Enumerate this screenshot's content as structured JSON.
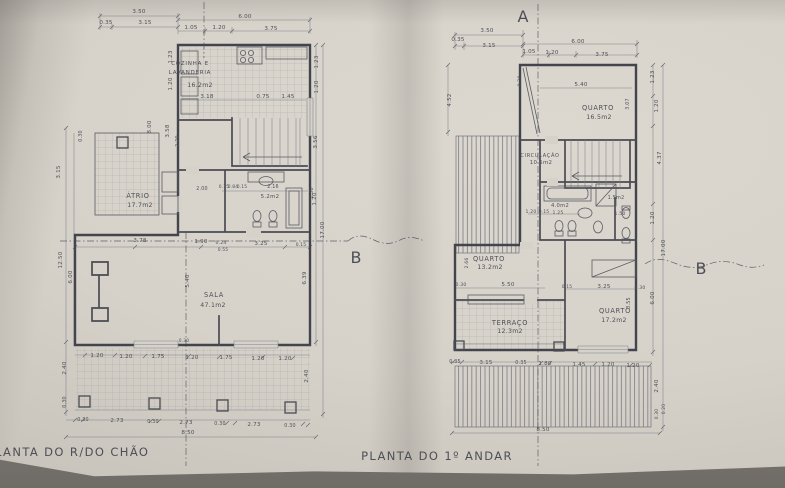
{
  "photo": {
    "paper_color": "#d6d2ca",
    "backdrop_color": "#8a8680",
    "ink_color": "#4e4f56"
  },
  "drawing": {
    "left_plan": {
      "title": "PLANTA DO R/DO CHÃO",
      "section_marker_b": "B",
      "rooms": [
        {
          "name": "COZINHA E LAVANDERIA",
          "area": "16.2m2"
        },
        {
          "name": "ÁTRIO",
          "area": "17.7m2"
        },
        {
          "name": "",
          "area": "5.2m2"
        },
        {
          "name": "SALA",
          "area": "47.1m2"
        }
      ],
      "labels": [
        {
          "t": "3.50",
          "x": 139,
          "y": 13
        },
        {
          "t": "0.35",
          "x": 106,
          "y": 24
        },
        {
          "t": "3.15",
          "x": 145,
          "y": 24
        },
        {
          "t": "6.00",
          "x": 245,
          "y": 18
        },
        {
          "t": "1.05",
          "x": 191,
          "y": 29
        },
        {
          "t": "1.20",
          "x": 219,
          "y": 29
        },
        {
          "t": "3.75",
          "x": 271,
          "y": 30
        },
        {
          "t": "COZINHA E",
          "x": 190,
          "y": 65,
          "k": "room",
          "fs": 5.6,
          "a": "start"
        },
        {
          "t": "LAVANDERIA",
          "x": 190,
          "y": 74,
          "k": "room",
          "fs": 5.6,
          "a": "start"
        },
        {
          "t": "16.2m2",
          "x": 200,
          "y": 87,
          "k": "area",
          "a": "start"
        },
        {
          "t": "3.18",
          "x": 207,
          "y": 98
        },
        {
          "t": "0.75",
          "x": 263,
          "y": 98
        },
        {
          "t": "1.45",
          "x": 288,
          "y": 98
        },
        {
          "t": "1.23",
          "x": 172,
          "y": 57,
          "r": -90
        },
        {
          "t": "1.20",
          "x": 172,
          "y": 84,
          "r": -90
        },
        {
          "t": "8.00",
          "x": 151,
          "y": 127,
          "r": -90
        },
        {
          "t": "3.58",
          "x": 169,
          "y": 131,
          "r": -90
        },
        {
          "t": "2.20",
          "x": 179,
          "y": 141,
          "r": -90,
          "fs": 4.8
        },
        {
          "t": "0.30",
          "x": 82,
          "y": 136,
          "r": -90,
          "fs": 4.8
        },
        {
          "t": "3.15",
          "x": 60,
          "y": 172,
          "r": -90
        },
        {
          "t": "12.50",
          "x": 62,
          "y": 260,
          "r": -90
        },
        {
          "t": "6.00",
          "x": 72,
          "y": 277,
          "r": -90
        },
        {
          "t": "2.40",
          "x": 66,
          "y": 368,
          "r": -90
        },
        {
          "t": "0.30",
          "x": 66,
          "y": 402,
          "r": -90,
          "fs": 4.8
        },
        {
          "t": "2.00",
          "x": 202,
          "y": 190,
          "fs": 4.8
        },
        {
          "t": "ÁTRIO",
          "x": 138,
          "y": 198,
          "k": "room"
        },
        {
          "t": "17.7m2",
          "x": 140,
          "y": 207,
          "k": "area"
        },
        {
          "t": "0.15",
          "x": 224,
          "y": 188,
          "fs": 4.4
        },
        {
          "t": "0.84",
          "x": 233,
          "y": 188,
          "fs": 4.4
        },
        {
          "t": "0.15",
          "x": 242,
          "y": 188,
          "fs": 4.4
        },
        {
          "t": "2.16",
          "x": 273,
          "y": 188,
          "fs": 4.8
        },
        {
          "t": "5.2m2",
          "x": 270,
          "y": 198,
          "k": "area",
          "fs": 5.4
        },
        {
          "t": "1.30",
          "x": 313,
          "y": 193,
          "r": -90,
          "fs": 4.8
        },
        {
          "t": "1.23",
          "x": 318,
          "y": 62,
          "r": -90
        },
        {
          "t": "1.20",
          "x": 318,
          "y": 87,
          "r": -90
        },
        {
          "t": "3.56",
          "x": 317,
          "y": 142,
          "r": -90
        },
        {
          "t": "1.20",
          "x": 316,
          "y": 199,
          "r": -90
        },
        {
          "t": "17.00",
          "x": 324,
          "y": 230,
          "r": -90
        },
        {
          "t": "6.39",
          "x": 306,
          "y": 278,
          "r": -90
        },
        {
          "t": "2.40",
          "x": 308,
          "y": 376,
          "r": -90
        },
        {
          "t": "3.78",
          "x": 140,
          "y": 242
        },
        {
          "t": "1.90",
          "x": 201,
          "y": 243
        },
        {
          "t": "0.24",
          "x": 221,
          "y": 244,
          "fs": 4.6
        },
        {
          "t": "0.55",
          "x": 223,
          "y": 251,
          "fs": 4.4
        },
        {
          "t": "3.25",
          "x": 261,
          "y": 245
        },
        {
          "t": "0.15",
          "x": 301,
          "y": 246,
          "fs": 4.4
        },
        {
          "t": "SALA",
          "x": 214,
          "y": 297,
          "k": "room"
        },
        {
          "t": "47.1m2",
          "x": 213,
          "y": 307,
          "k": "area"
        },
        {
          "t": "5.40",
          "x": 189,
          "y": 281,
          "r": -90
        },
        {
          "t": "0.30",
          "x": 184,
          "y": 342,
          "fs": 4.4
        },
        {
          "t": "1.20",
          "x": 97,
          "y": 357
        },
        {
          "t": "1.20",
          "x": 126,
          "y": 358
        },
        {
          "t": "1.75",
          "x": 158,
          "y": 358
        },
        {
          "t": "1.20",
          "x": 192,
          "y": 359
        },
        {
          "t": "1.75",
          "x": 226,
          "y": 359
        },
        {
          "t": "1.20",
          "x": 258,
          "y": 360
        },
        {
          "t": "1.20",
          "x": 285,
          "y": 360
        },
        {
          "t": "0.30",
          "x": 83,
          "y": 421,
          "fs": 4.8
        },
        {
          "t": "2.73",
          "x": 117,
          "y": 422
        },
        {
          "t": "0.30",
          "x": 153,
          "y": 423,
          "fs": 4.8
        },
        {
          "t": "2.73",
          "x": 186,
          "y": 424
        },
        {
          "t": "0.30",
          "x": 220,
          "y": 425,
          "fs": 4.8
        },
        {
          "t": "2.73",
          "x": 254,
          "y": 426
        },
        {
          "t": "0.30",
          "x": 290,
          "y": 427,
          "fs": 4.8
        },
        {
          "t": "8.50",
          "x": 188,
          "y": 434
        }
      ]
    },
    "right_plan": {
      "title": "PLANTA DO 1º ANDAR",
      "section_marker_a": "A",
      "section_marker_b": "B",
      "rooms": [
        {
          "name": "QUARTO",
          "area": "16.5m2"
        },
        {
          "name": "CIRCULAÇÃO",
          "area": "10.5m2"
        },
        {
          "name": "",
          "area": "4.0m2"
        },
        {
          "name": "",
          "area": "1.5m2"
        },
        {
          "name": "QUARTO",
          "area": "13.2m2"
        },
        {
          "name": "TERRAÇO",
          "area": "12.3m2"
        },
        {
          "name": "QUARTO",
          "area": "17.2m2"
        }
      ],
      "labels": [
        {
          "t": "3.50",
          "x": 487,
          "y": 32
        },
        {
          "t": "0.35",
          "x": 458,
          "y": 41
        },
        {
          "t": "3.15",
          "x": 489,
          "y": 47
        },
        {
          "t": "6.00",
          "x": 578,
          "y": 43
        },
        {
          "t": "1.05",
          "x": 529,
          "y": 53
        },
        {
          "t": "1.20",
          "x": 552,
          "y": 54
        },
        {
          "t": "3.75",
          "x": 602,
          "y": 56
        },
        {
          "t": "QUARTO",
          "x": 598,
          "y": 110,
          "k": "room"
        },
        {
          "t": "16.5m2",
          "x": 599,
          "y": 119,
          "k": "area"
        },
        {
          "t": "5.40",
          "x": 581,
          "y": 86
        },
        {
          "t": "0.30",
          "x": 521,
          "y": 81,
          "r": -90,
          "fs": 4.6
        },
        {
          "t": "4.52",
          "x": 451,
          "y": 100,
          "r": -90
        },
        {
          "t": "3.07",
          "x": 629,
          "y": 104,
          "r": -90,
          "fs": 4.8
        },
        {
          "t": "1.23",
          "x": 654,
          "y": 77,
          "r": -90
        },
        {
          "t": "1.20",
          "x": 658,
          "y": 106,
          "r": -90
        },
        {
          "t": "CIRCULAÇÃO",
          "x": 540,
          "y": 157,
          "k": "room",
          "fs": 5
        },
        {
          "t": "10.5m2",
          "x": 541,
          "y": 164,
          "k": "area",
          "fs": 5.4
        },
        {
          "t": "4.37",
          "x": 661,
          "y": 158,
          "r": -90
        },
        {
          "t": "4.0m2",
          "x": 560,
          "y": 207,
          "k": "area",
          "fs": 5.2
        },
        {
          "t": "1.20",
          "x": 531,
          "y": 213,
          "fs": 4.6
        },
        {
          "t": "0.15",
          "x": 544,
          "y": 213,
          "fs": 4.4
        },
        {
          "t": "1.25",
          "x": 558,
          "y": 214,
          "fs": 4.6
        },
        {
          "t": "1.5m2",
          "x": 616,
          "y": 199,
          "k": "area",
          "fs": 4.8
        },
        {
          "t": "1.50",
          "x": 620,
          "y": 215,
          "fs": 4.6
        },
        {
          "t": "1.20",
          "x": 654,
          "y": 218,
          "r": -90
        },
        {
          "t": "QUARTO",
          "x": 489,
          "y": 261,
          "k": "room"
        },
        {
          "t": "13.2m2",
          "x": 490,
          "y": 269,
          "k": "area"
        },
        {
          "t": "2.66",
          "x": 468,
          "y": 263,
          "r": -90,
          "fs": 4.6
        },
        {
          "t": "0.30",
          "x": 461,
          "y": 286,
          "fs": 4.6
        },
        {
          "t": "5.50",
          "x": 508,
          "y": 286
        },
        {
          "t": "17.00",
          "x": 665,
          "y": 248,
          "r": -90
        },
        {
          "t": "TERRAÇO",
          "x": 510,
          "y": 325,
          "k": "room"
        },
        {
          "t": "12.3m2",
          "x": 510,
          "y": 333,
          "k": "area"
        },
        {
          "t": "0.15",
          "x": 567,
          "y": 288,
          "fs": 4.4
        },
        {
          "t": "3.25",
          "x": 604,
          "y": 288
        },
        {
          "t": "0.30",
          "x": 640,
          "y": 289,
          "fs": 4.6
        },
        {
          "t": "QUARTO",
          "x": 615,
          "y": 313,
          "k": "room"
        },
        {
          "t": "17.2m2",
          "x": 614,
          "y": 322,
          "k": "area"
        },
        {
          "t": "3.55",
          "x": 630,
          "y": 303,
          "r": -90,
          "fs": 4.8
        },
        {
          "t": "6.00",
          "x": 654,
          "y": 298,
          "r": -90
        },
        {
          "t": "0.35",
          "x": 455,
          "y": 363,
          "fs": 4.8
        },
        {
          "t": "3.15",
          "x": 486,
          "y": 364
        },
        {
          "t": "0.35",
          "x": 521,
          "y": 364,
          "fs": 4.8
        },
        {
          "t": "1.80",
          "x": 545,
          "y": 365
        },
        {
          "t": "1.45",
          "x": 579,
          "y": 366
        },
        {
          "t": "1.20",
          "x": 608,
          "y": 366
        },
        {
          "t": "1.20",
          "x": 633,
          "y": 367
        },
        {
          "t": "8.50",
          "x": 543,
          "y": 431
        },
        {
          "t": "2.40",
          "x": 658,
          "y": 386,
          "r": -90
        },
        {
          "t": "0.30",
          "x": 658,
          "y": 414,
          "r": -90,
          "fs": 4.4
        },
        {
          "t": "0.20",
          "x": 665,
          "y": 409,
          "r": -90,
          "fs": 4.4
        }
      ]
    }
  }
}
